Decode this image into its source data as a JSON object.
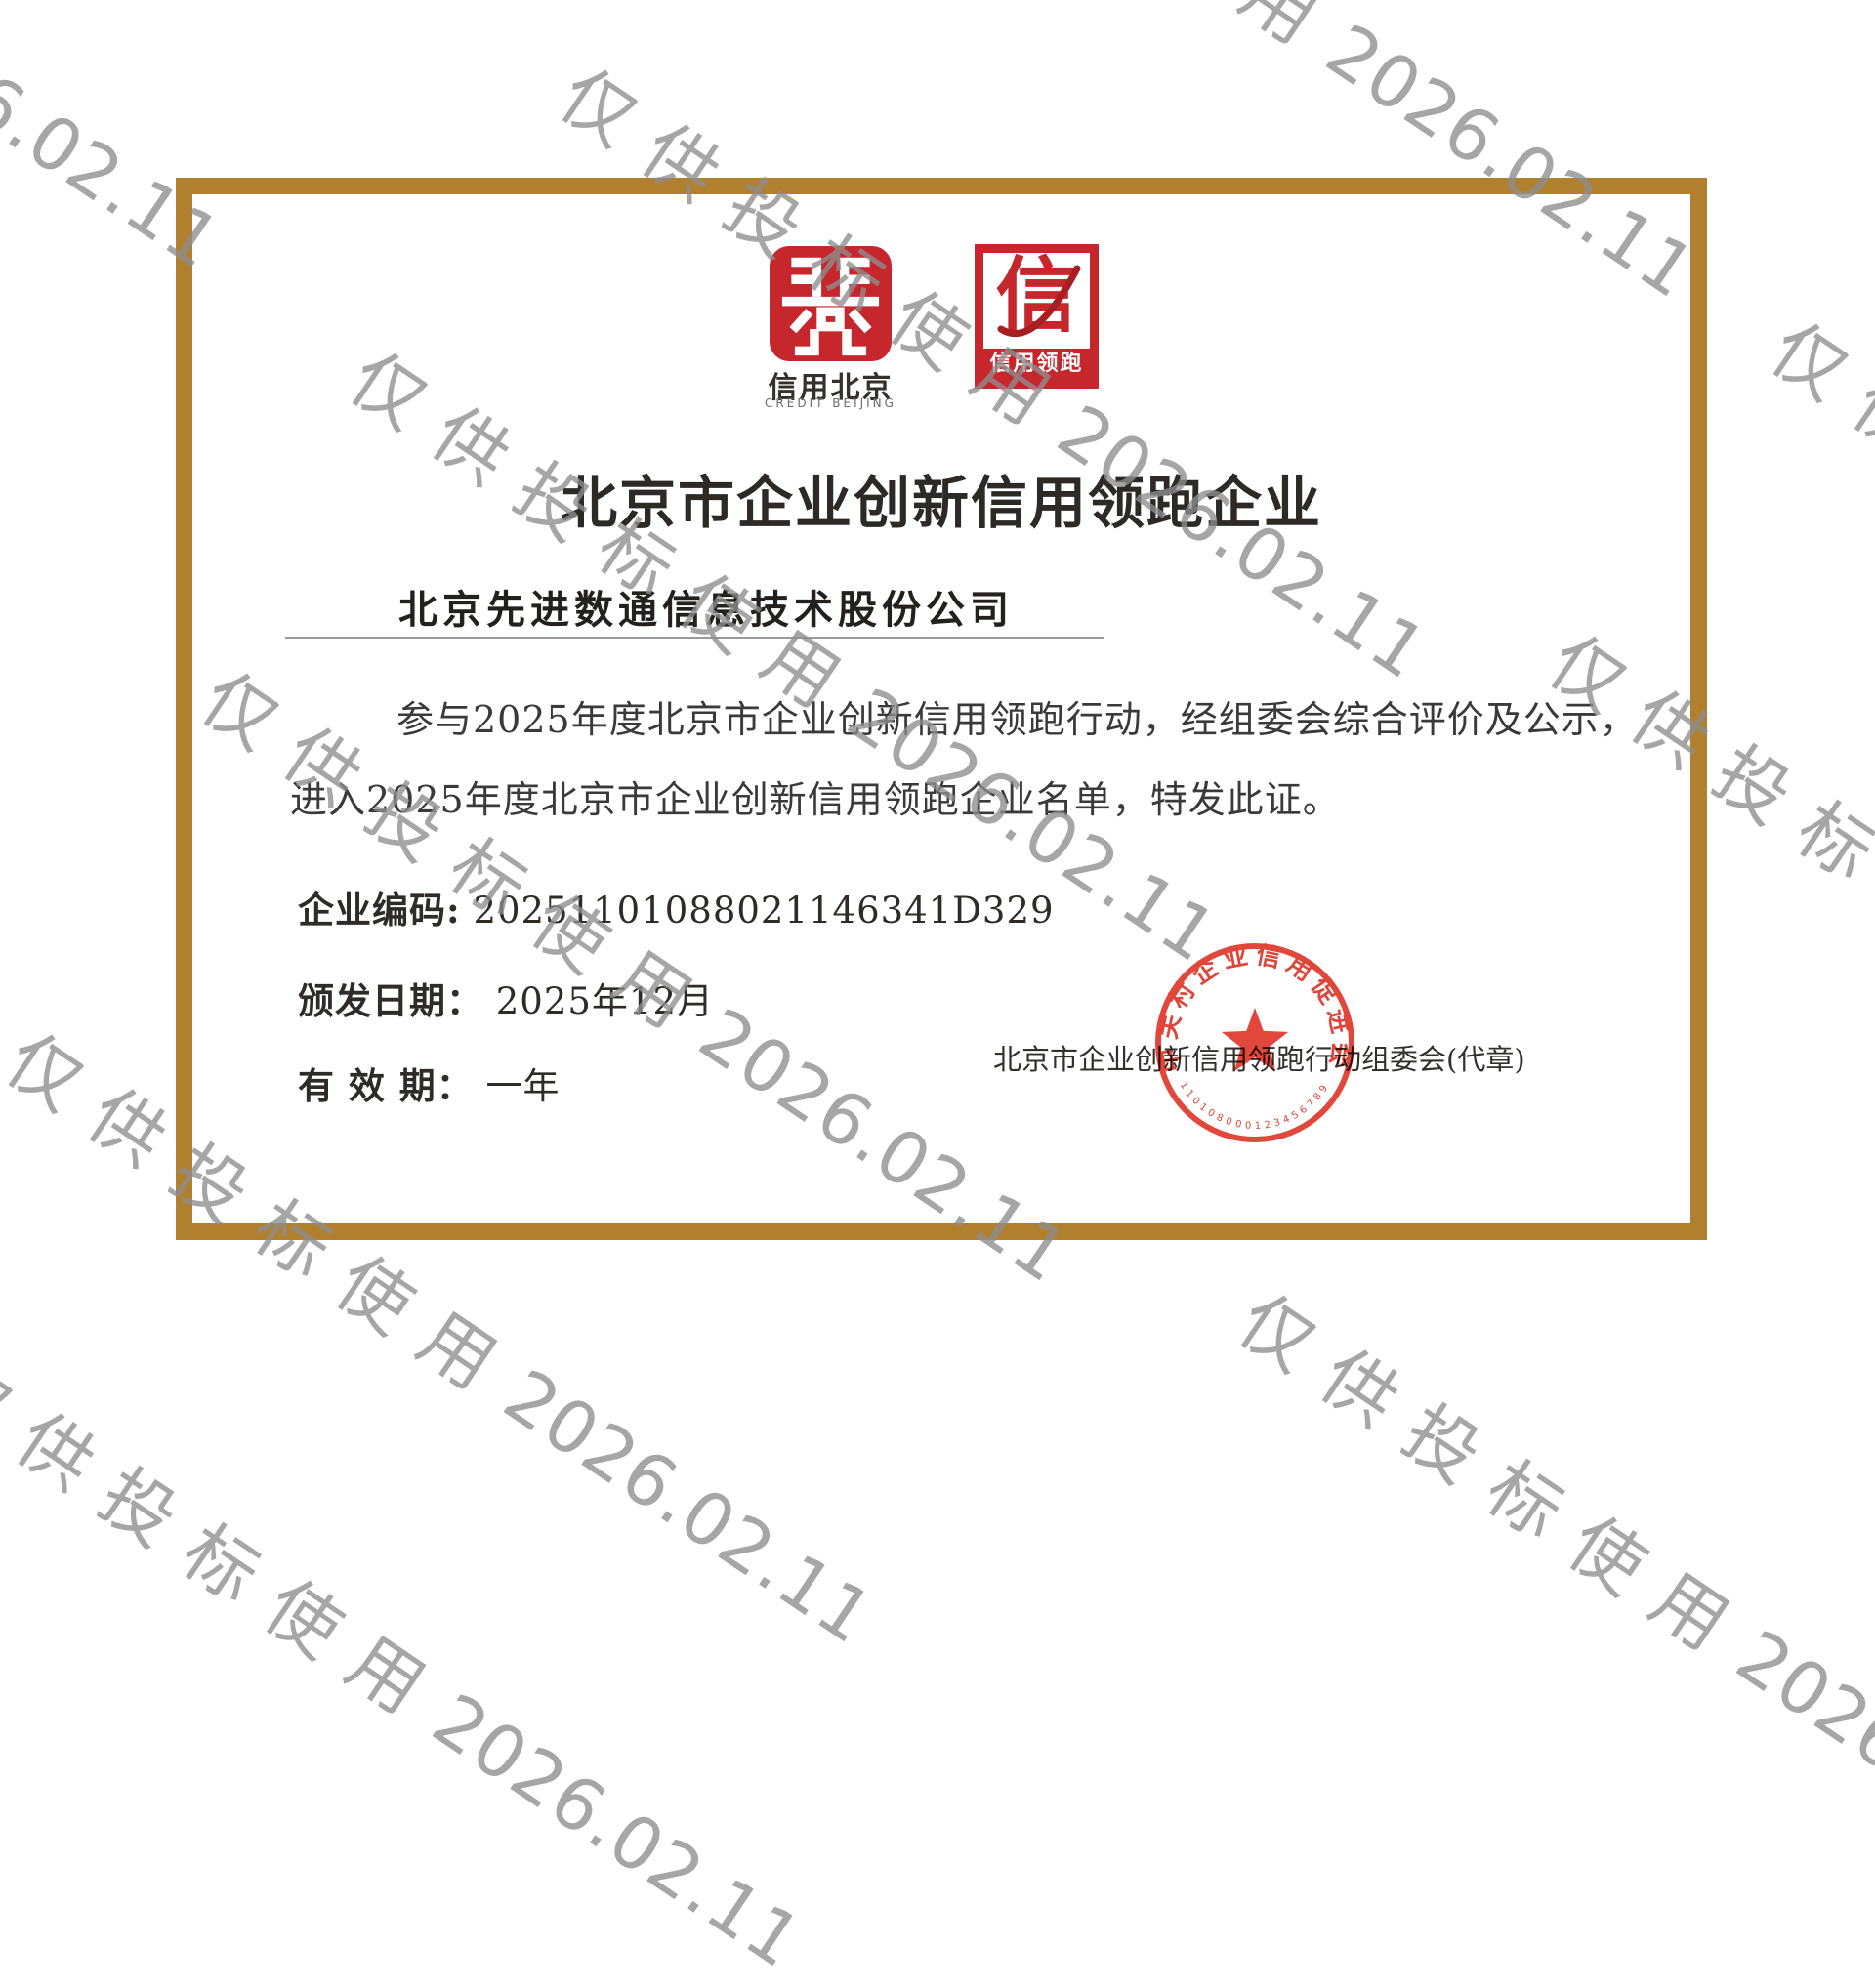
{
  "watermark": {
    "text_cjk": "仅供投标使用",
    "text_date": "2026.02.11",
    "color": "#8e8e8e"
  },
  "certificate": {
    "frame_color": "#b1802f",
    "logos": {
      "credit_beijing": {
        "label_cn": "信用北京",
        "label_en": "CREDIT BEIJING",
        "color": "#c5272d"
      },
      "credit_leader": {
        "glyph": "信",
        "band_label": "信用领跑",
        "color": "#c5272d"
      }
    },
    "title": "北京市企业创新信用领跑企业",
    "company": "北京先进数通信息技术股份公司",
    "body_line1": "参与2025年度北京市企业创新信用领跑行动，经组委会综合评价及公示，",
    "body_line2": "进入2025年度北京市企业创新信用领跑企业名单，特发此证。",
    "fields": [
      {
        "label": "企业编码:",
        "value": "20251101088021146341D329"
      },
      {
        "label": "颁发日期：",
        "value": "2025年12月"
      },
      {
        "label": "有 效 期：",
        "value": "一年"
      }
    ],
    "issuer": "北京市企业创新信用领跑行动组委会(代章)",
    "seal": {
      "ring_text": "中关村企业信用促进会",
      "serial": "110108000123456789",
      "color": "#e0372a"
    }
  }
}
